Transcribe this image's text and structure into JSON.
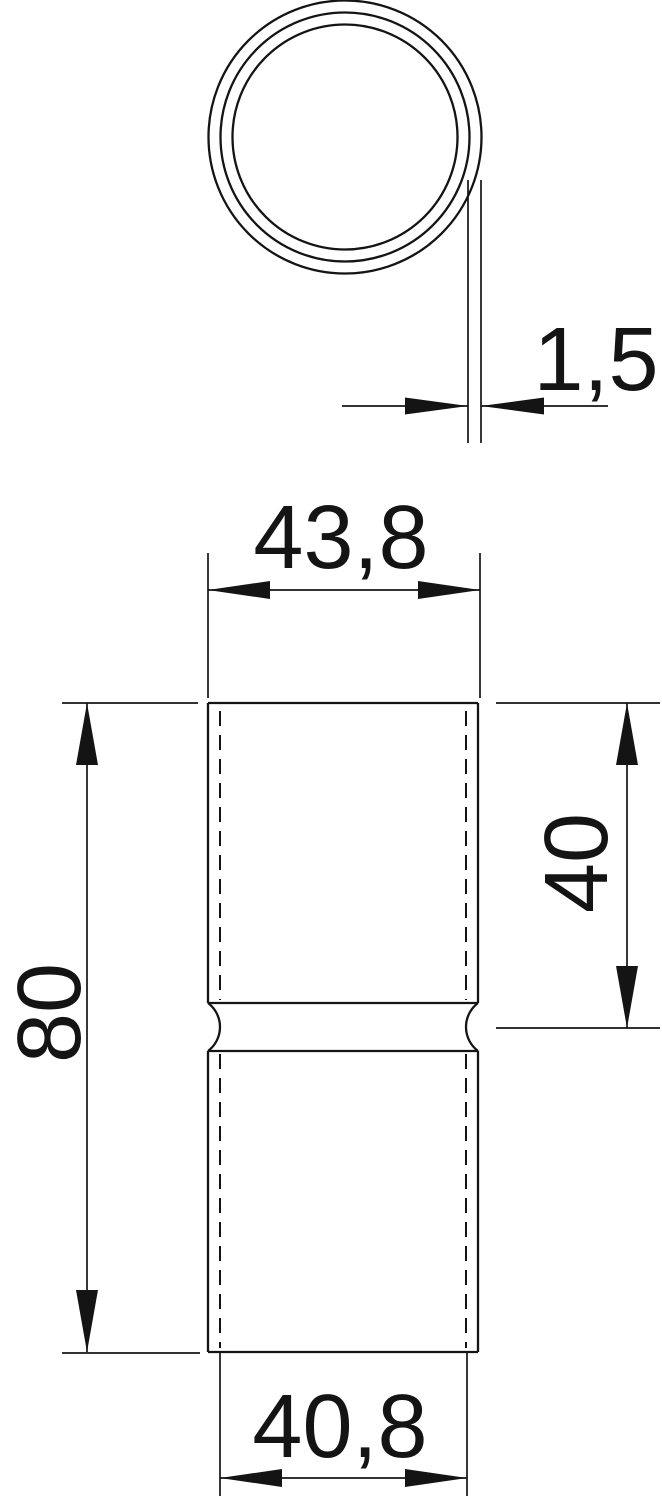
{
  "drawing": {
    "kind": "technical dimension drawing of a pipe coupling sleeve",
    "views": {
      "top_view": "tube cross-section (three concentric circles)",
      "front_view": "coupling body with center stop bead and hidden inner-wall lines"
    },
    "dimensions": {
      "wall_thickness": "1,5",
      "outer_width": "43,8",
      "overall_length": "80",
      "socket_depth": "40",
      "inner_width": "40,8"
    },
    "colors": {
      "line": "#141414",
      "background": "#ffffff"
    }
  }
}
